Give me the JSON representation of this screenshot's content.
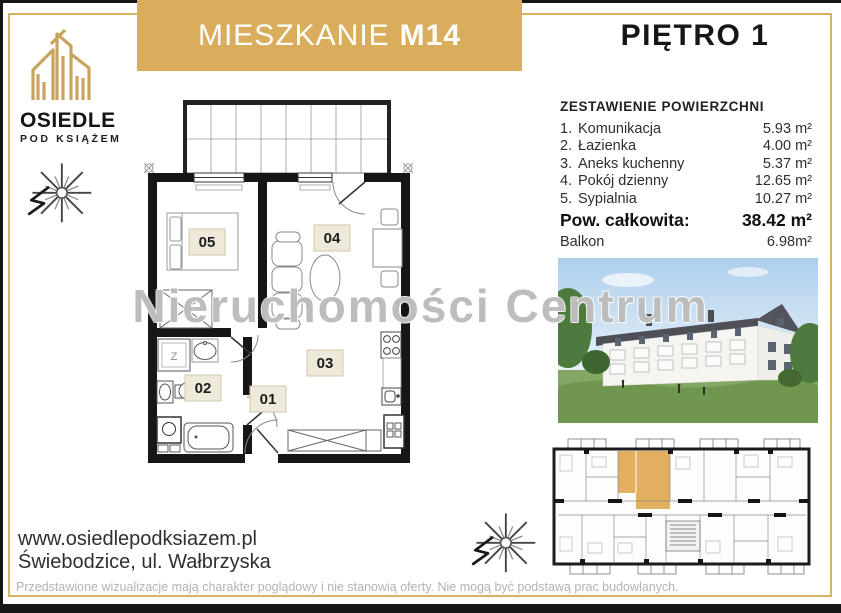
{
  "header": {
    "apartment_label": "MIESZKANIE",
    "apartment_number": "M14",
    "floor": "PIĘTRO 1"
  },
  "brand": {
    "line1": "OSIEDLE",
    "line2": "POD KSIĄŻEM"
  },
  "area_table": {
    "title": "ZESTAWIENIE POWIERZCHNI",
    "rows": [
      {
        "num": "1.",
        "label": "Komunikacja",
        "value": "5.93 m²"
      },
      {
        "num": "2.",
        "label": "Łazienka",
        "value": "4.00 m²"
      },
      {
        "num": "3.",
        "label": "Aneks kuchenny",
        "value": "5.37 m²"
      },
      {
        "num": "4.",
        "label": "Pokój dzienny",
        "value": "12.65 m²"
      },
      {
        "num": "5.",
        "label": "Sypialnia",
        "value": "10.27 m²"
      }
    ],
    "total_label": "Pow. całkowita:",
    "total_value": "38.42 m²",
    "balcony_label": "Balkon",
    "balcony_value": "6.98m²"
  },
  "floor_plan": {
    "rooms": {
      "r01": "01",
      "r02": "02",
      "r03": "03",
      "r04": "04",
      "r05": "05"
    },
    "closet": "Z"
  },
  "watermark": "Nieruchomości Centrum",
  "footer": {
    "website": "www.osiedlepodksiazem.pl",
    "address": "Świebodzice, ul. Wałbrzyska",
    "disclaimer": "Przedstawione wizualizacje mają charakter poglądowy i nie stanowią oferty. Nie mogą być podstawą prac budowlanych."
  },
  "colors": {
    "gold": "#d9ad5c",
    "gold_line": "#d8b263",
    "black_bar": "#161616",
    "highlight_unit": "#dfa54e",
    "label_bg": "#efe9da"
  }
}
